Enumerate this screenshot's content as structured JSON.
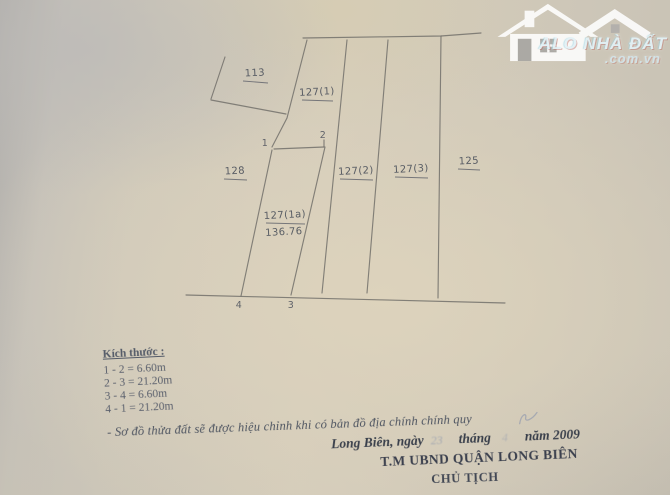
{
  "watermark": {
    "title": "ALO NHÀ ĐẤT",
    "domain": ".com.vn"
  },
  "diagram": {
    "labels": {
      "p113": "113",
      "p127_1": "127(1)",
      "p128": "128",
      "p127_2": "127(2)",
      "p127_3": "127(3)",
      "p125": "125",
      "p127_1a": "127(1a)",
      "p127_1a_area": "136.76"
    },
    "points": {
      "p1": "1",
      "p2": "2",
      "p3": "3",
      "p4": "4"
    }
  },
  "dimensions": {
    "title": "Kích thước :",
    "items": [
      "1 - 2 = 6.60m",
      "2 - 3 = 21.20m",
      "3 - 4 = 6.60m",
      "4 - 1 = 21.20m"
    ]
  },
  "note": {
    "text": "- Sơ đồ thửa đất sẽ được hiệu chỉnh khi có bản đồ địa chính chính quy"
  },
  "date_line": {
    "place_prefix": "Long Biên, ngày",
    "day": "23",
    "month_label": "tháng",
    "month": "4",
    "year_label": "năm 2009"
  },
  "signature": {
    "authority": "T.M UBND QUẬN LONG BIÊN",
    "title": "CHỦ TỊCH"
  }
}
